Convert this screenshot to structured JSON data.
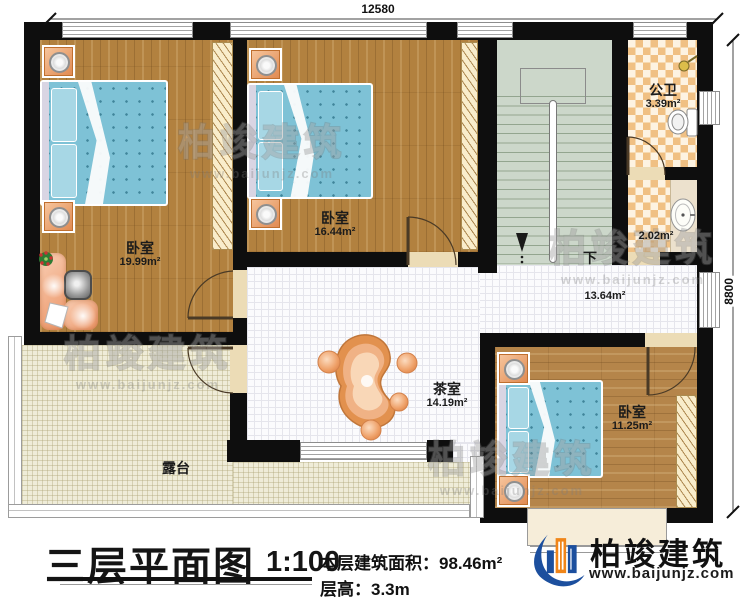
{
  "dimensions": {
    "top": "12580",
    "right": "8800"
  },
  "rooms": {
    "bedroom1": {
      "name": "卧室",
      "area": "19.99m²"
    },
    "bedroom2": {
      "name": "卧室",
      "area": "16.44m²"
    },
    "bedroom3": {
      "name": "卧室",
      "area": "11.25m²"
    },
    "bathroom": {
      "name": "公卫",
      "area": "3.39m²"
    },
    "washroom": {
      "area": "2.02m²"
    },
    "hallway": {
      "area": "13.64m²"
    },
    "tearoom": {
      "name": "茶室",
      "area": "14.19m²"
    },
    "terrace": {
      "name": "露台"
    },
    "stairs": {
      "direction_label": "下"
    }
  },
  "title_block": {
    "title": "三层平面图",
    "scale": "1:100",
    "area_label": "本层建筑面积：",
    "area_value": "98.46m²",
    "floor_height_label": "层高：",
    "floor_height_value": "3.3m"
  },
  "brand": {
    "name": "柏竣建筑",
    "website": "www.baijunjz.com"
  },
  "watermark": {
    "name": "柏竣建筑",
    "website": "www.baijunjz.com"
  },
  "colors": {
    "wall": "#0e0e0e",
    "wood": "#b2813f",
    "bed_blue": "#7ec2d6",
    "tile": "#fbfbfd",
    "terrace": "#efecd8",
    "stairs": "#ccd7ca",
    "checker": "#f0c083",
    "salmon": "#efa384",
    "brand_blue": "#1c4f9e",
    "brand_orange": "#f08519"
  }
}
